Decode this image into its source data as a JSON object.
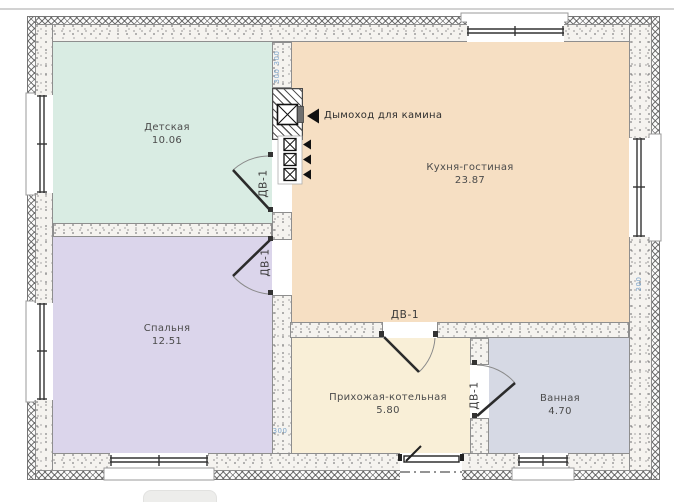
{
  "page": {
    "bottom_button": {
      "label": ""
    }
  },
  "plan": {
    "rooms": [
      {
        "name": "Детская",
        "area": "10.06",
        "color": "#d9ece3"
      },
      {
        "name": "Кухня-гостиная",
        "area": "23.87",
        "color": "#f6dfc3"
      },
      {
        "name": "Спальня",
        "area": "12.51",
        "color": "#dbd5eb"
      },
      {
        "name": "Прихожая-котельная",
        "area": "5.80",
        "color": "#f9efd7"
      },
      {
        "name": "Ванная",
        "area": "4.70",
        "color": "#d6d9e4"
      }
    ],
    "doors": [
      {
        "label": "ДВ-1",
        "location": "children-room-to-kitchen"
      },
      {
        "label": "ДВ-1",
        "location": "bedroom-to-kitchen"
      },
      {
        "label": "ДВ-1",
        "location": "kitchen-to-hallway"
      },
      {
        "label": "ДВ-1",
        "location": "hallway-to-bathroom"
      }
    ],
    "annotations": {
      "chimney_note": "Дымоход для камина",
      "dims": [
        "300",
        "300",
        "300",
        "300"
      ]
    },
    "colors": {
      "wall_stipple_bg": "#f5f3ef",
      "dim_text": "#7ea6cc",
      "linework": "#2b2b2b",
      "hairline": "#d2d2d2"
    }
  }
}
